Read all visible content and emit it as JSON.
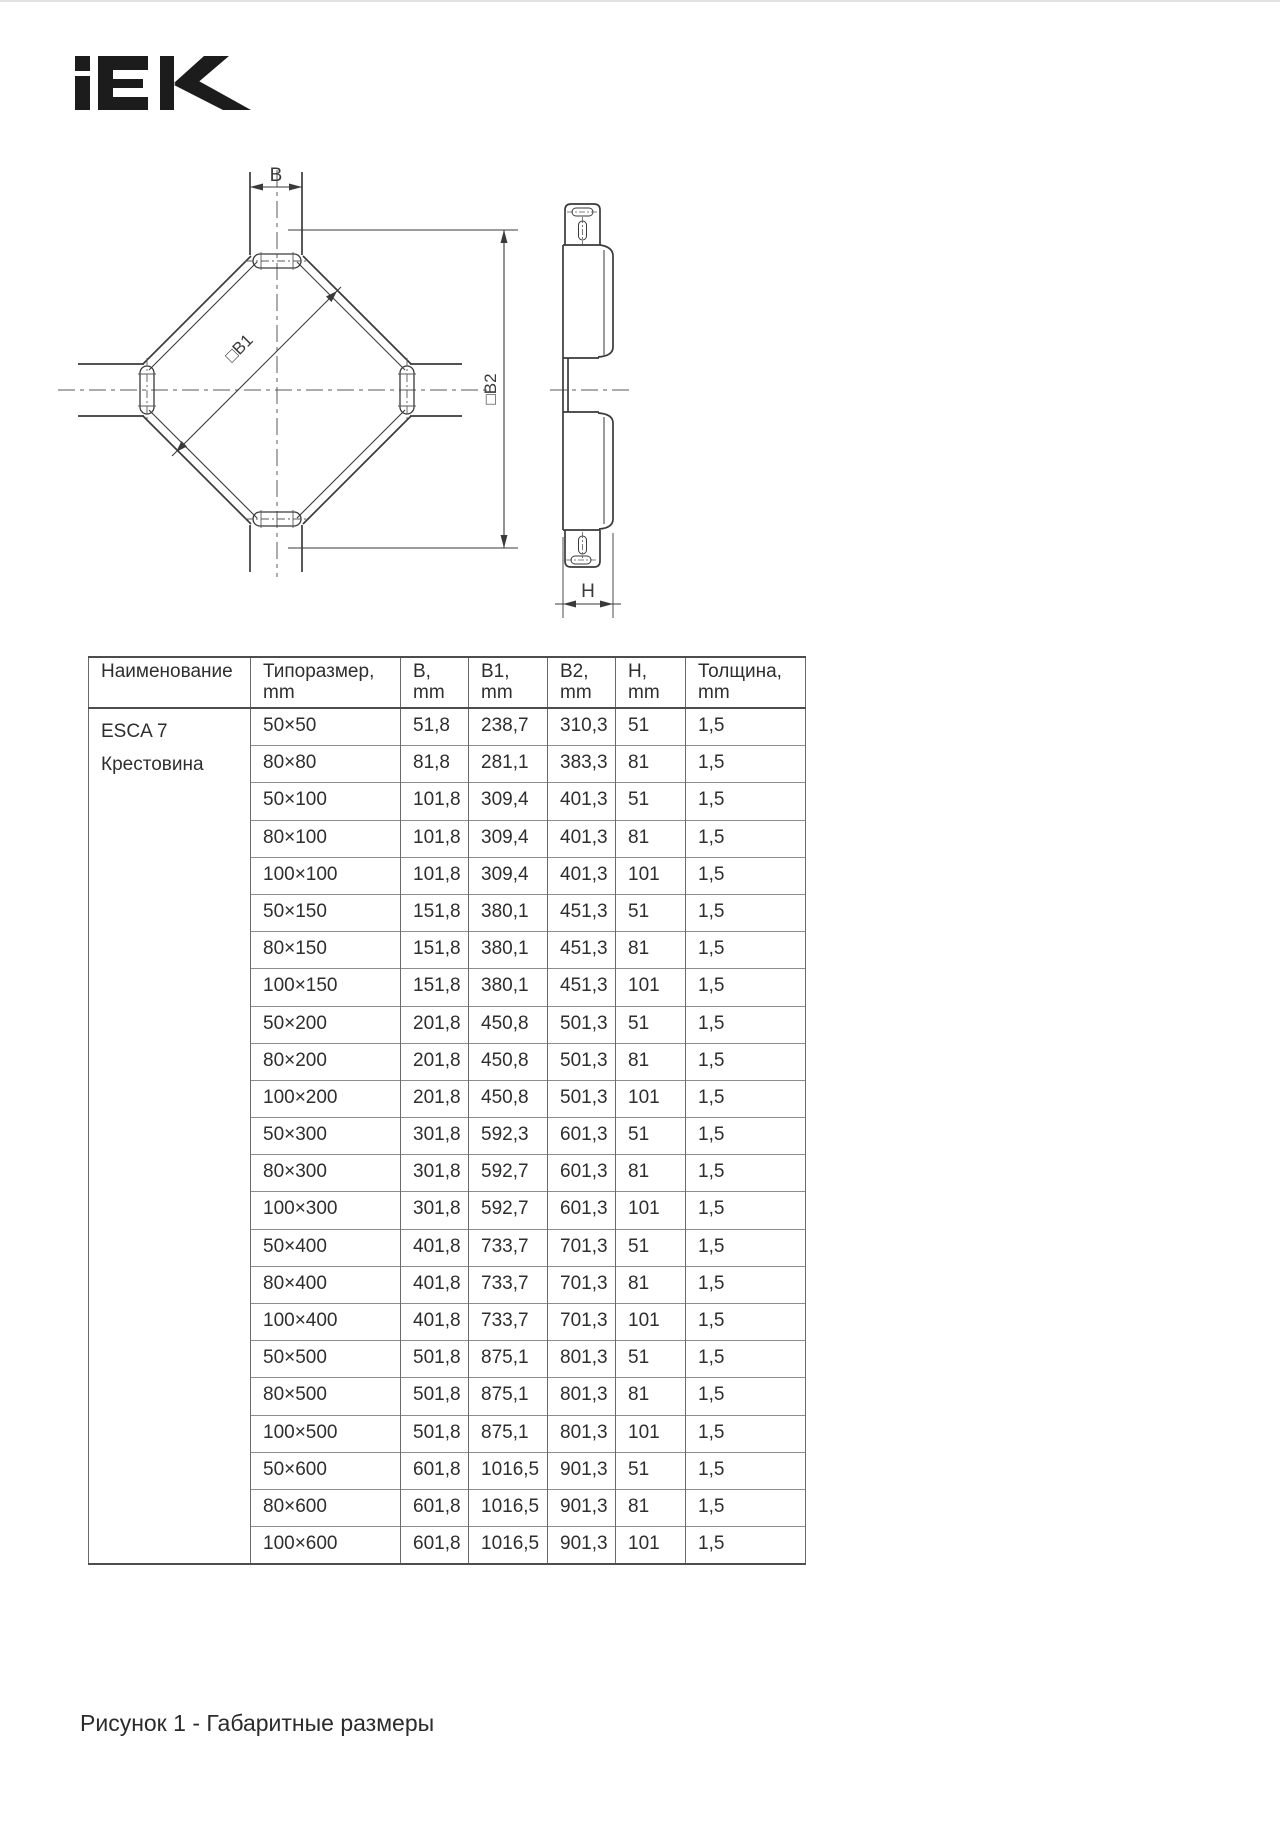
{
  "logo": {
    "name": "IEK",
    "color": "#1c1c1c"
  },
  "drawing": {
    "labels": {
      "b": "B",
      "b1": "□B1",
      "b2": "□B2",
      "h": "H"
    }
  },
  "table": {
    "headers": [
      {
        "label": "Наименование",
        "unit": ""
      },
      {
        "label": "Типоразмер,",
        "unit": "mm"
      },
      {
        "label": "B,",
        "unit": "mm"
      },
      {
        "label": "B1,",
        "unit": "mm"
      },
      {
        "label": "B2,",
        "unit": "mm"
      },
      {
        "label": "H,",
        "unit": "mm"
      },
      {
        "label": "Толщина,",
        "unit": "mm"
      }
    ],
    "product": {
      "line1": "ESCA 7",
      "line2": "Крестовина"
    },
    "rows": [
      [
        "50×50",
        "51,8",
        "238,7",
        "310,3",
        "51",
        "1,5"
      ],
      [
        "80×80",
        "81,8",
        "281,1",
        "383,3",
        "81",
        "1,5"
      ],
      [
        "50×100",
        "101,8",
        "309,4",
        "401,3",
        "51",
        "1,5"
      ],
      [
        "80×100",
        "101,8",
        "309,4",
        "401,3",
        "81",
        "1,5"
      ],
      [
        "100×100",
        "101,8",
        "309,4",
        "401,3",
        "101",
        "1,5"
      ],
      [
        "50×150",
        "151,8",
        "380,1",
        "451,3",
        "51",
        "1,5"
      ],
      [
        "80×150",
        "151,8",
        "380,1",
        "451,3",
        "81",
        "1,5"
      ],
      [
        "100×150",
        "151,8",
        "380,1",
        "451,3",
        "101",
        "1,5"
      ],
      [
        "50×200",
        "201,8",
        "450,8",
        "501,3",
        "51",
        "1,5"
      ],
      [
        "80×200",
        "201,8",
        "450,8",
        "501,3",
        "81",
        "1,5"
      ],
      [
        "100×200",
        "201,8",
        "450,8",
        "501,3",
        "101",
        "1,5"
      ],
      [
        "50×300",
        "301,8",
        "592,3",
        "601,3",
        "51",
        "1,5"
      ],
      [
        "80×300",
        "301,8",
        "592,7",
        "601,3",
        "81",
        "1,5"
      ],
      [
        "100×300",
        "301,8",
        "592,7",
        "601,3",
        "101",
        "1,5"
      ],
      [
        "50×400",
        "401,8",
        "733,7",
        "701,3",
        "51",
        "1,5"
      ],
      [
        "80×400",
        "401,8",
        "733,7",
        "701,3",
        "81",
        "1,5"
      ],
      [
        "100×400",
        "401,8",
        "733,7",
        "701,3",
        "101",
        "1,5"
      ],
      [
        "50×500",
        "501,8",
        "875,1",
        "801,3",
        "51",
        "1,5"
      ],
      [
        "80×500",
        "501,8",
        "875,1",
        "801,3",
        "81",
        "1,5"
      ],
      [
        "100×500",
        "501,8",
        "875,1",
        "801,3",
        "101",
        "1,5"
      ],
      [
        "50×600",
        "601,8",
        "1016,5",
        "901,3",
        "51",
        "1,5"
      ],
      [
        "80×600",
        "601,8",
        "1016,5",
        "901,3",
        "81",
        "1,5"
      ],
      [
        "100×600",
        "601,8",
        "1016,5",
        "901,3",
        "101",
        "1,5"
      ]
    ]
  },
  "caption": "Рисунок 1 - Габаритные размеры"
}
